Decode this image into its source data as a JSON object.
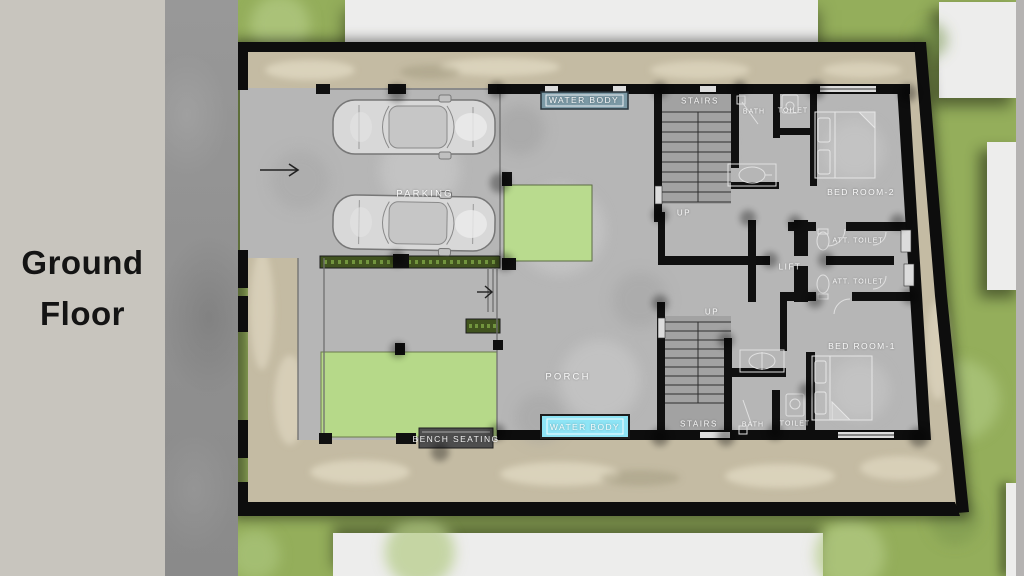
{
  "slide": {
    "title_line1": "Ground",
    "title_line2": "Floor"
  },
  "plan": {
    "rooms": {
      "parking": "PARKING",
      "porch": "PORCH",
      "lift": "LIFT",
      "bedroom2": "BED ROOM-2",
      "bedroom1": "BED ROOM-1",
      "stairs_top": "STAIRS",
      "stairs_bottom": "STAIRS",
      "up_top": "UP",
      "up_bottom": "UP",
      "bath_top": "BATH",
      "bath_bottom": "BATH",
      "toilet_top": "TOILET",
      "toilet_bottom": "TOILET",
      "att_toilet_top": "ATT. TOILET",
      "att_toilet_bottom": "ATT. TOILET"
    },
    "features": {
      "water_body_top": "WATER BODY",
      "water_body_bottom": "WATER BODY",
      "bench_seating": "BENCH SEATING"
    },
    "colors": {
      "panel_bg": "#c8c5be",
      "road": "#909090",
      "grass": "#94ae5b",
      "lawn": "#b7d98b",
      "yard": "#c4bba3",
      "floor": "#b6b6b6",
      "wall": "#111111",
      "water_top": "#7b99a5",
      "water_bottom": "#8ee4f5",
      "hedge": "#41531f",
      "neighbor_block": "#ededec"
    }
  }
}
